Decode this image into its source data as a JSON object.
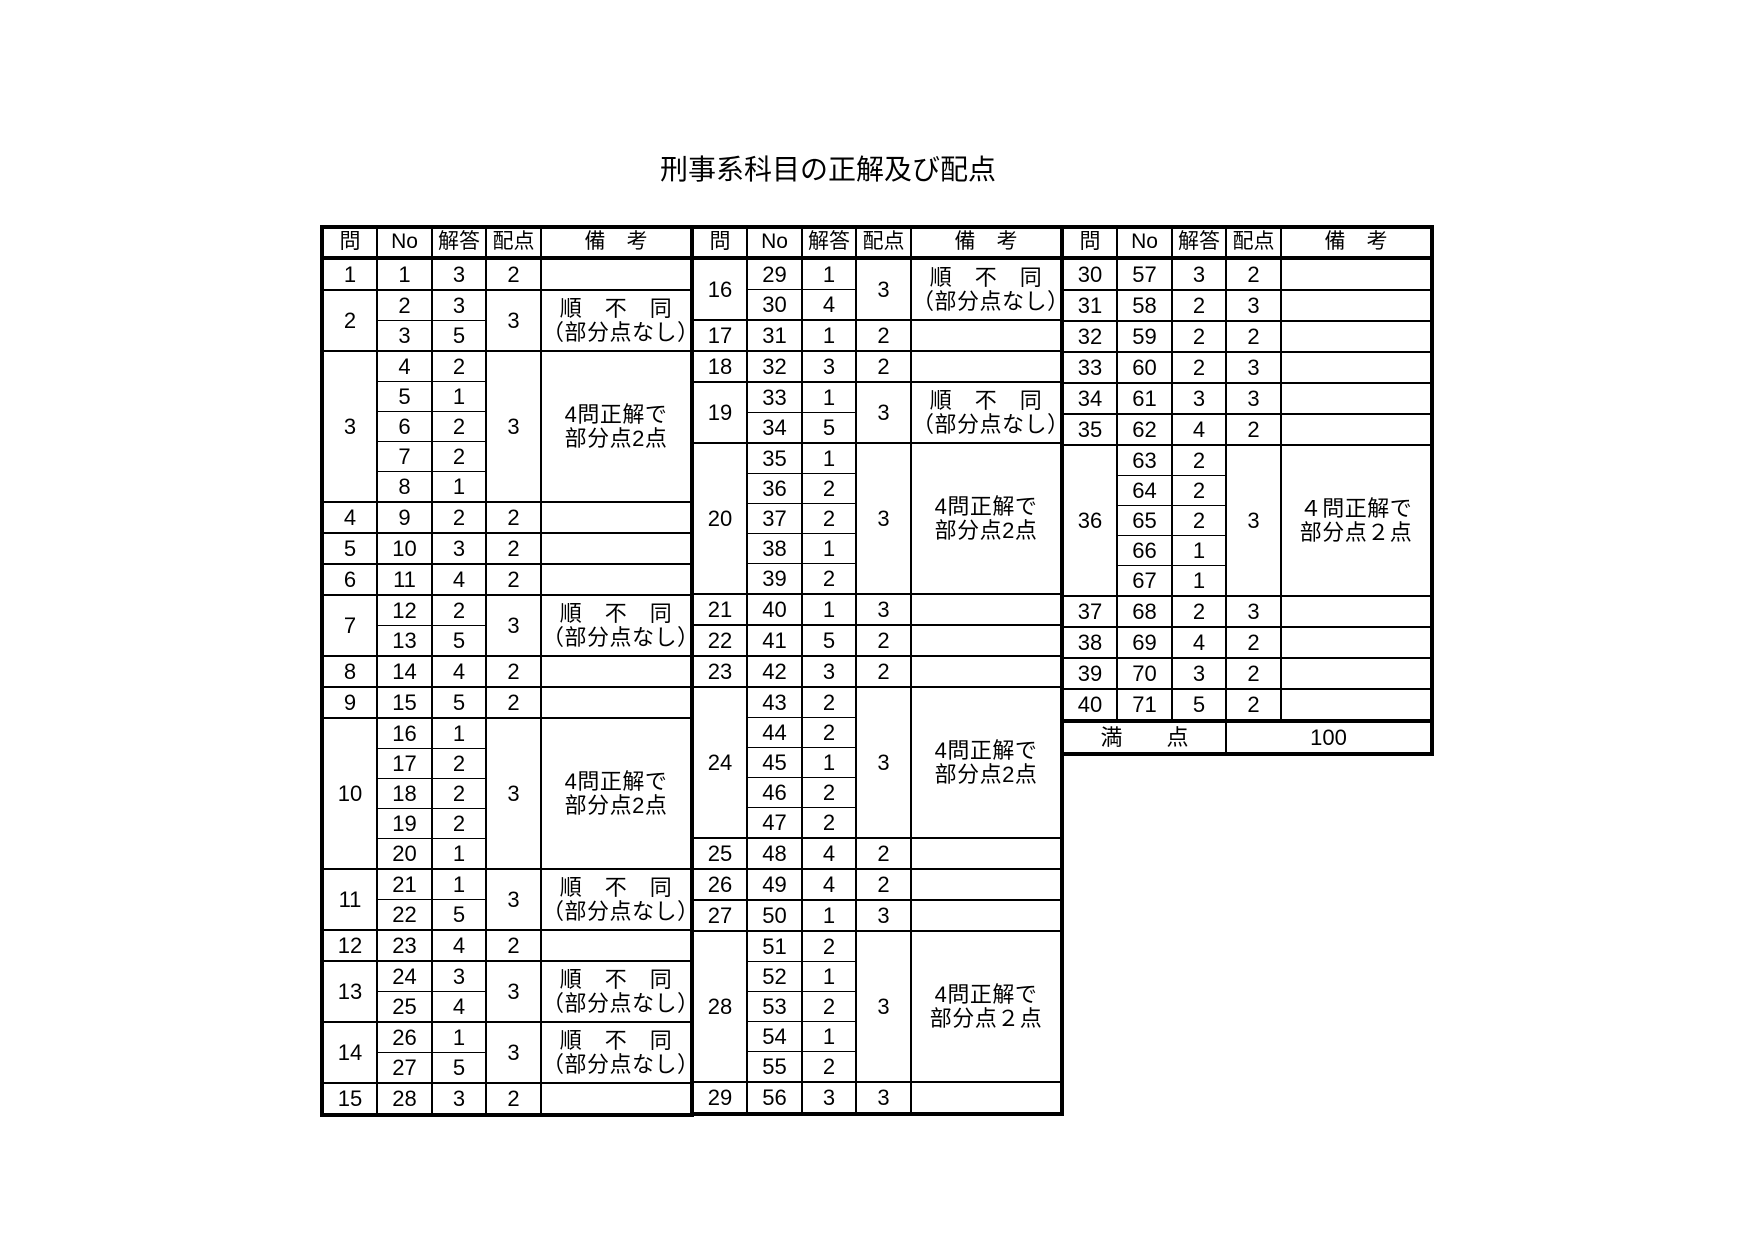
{
  "title": "刑事系科目の正解及び配点",
  "colors": {
    "ink": "#000000",
    "paper": "#ffffff"
  },
  "headers": {
    "q": "問",
    "no": "No",
    "ans": "解答",
    "pts": "配点",
    "note": "備　考"
  },
  "tables": [
    {
      "groups": [
        {
          "q": "1",
          "rows": [
            {
              "no": "1",
              "ans": "3"
            }
          ],
          "pts": "2",
          "note": ""
        },
        {
          "q": "2",
          "rows": [
            {
              "no": "2",
              "ans": "3"
            },
            {
              "no": "3",
              "ans": "5"
            }
          ],
          "pts": "3",
          "note": "順　不　同\n（部分点なし）"
        },
        {
          "q": "3",
          "rows": [
            {
              "no": "4",
              "ans": "2"
            },
            {
              "no": "5",
              "ans": "1"
            },
            {
              "no": "6",
              "ans": "2"
            },
            {
              "no": "7",
              "ans": "2"
            },
            {
              "no": "8",
              "ans": "1"
            }
          ],
          "pts": "3",
          "note": "4問正解で\n部分点2点"
        },
        {
          "q": "4",
          "rows": [
            {
              "no": "9",
              "ans": "2"
            }
          ],
          "pts": "2",
          "note": ""
        },
        {
          "q": "5",
          "rows": [
            {
              "no": "10",
              "ans": "3"
            }
          ],
          "pts": "2",
          "note": ""
        },
        {
          "q": "6",
          "rows": [
            {
              "no": "11",
              "ans": "4"
            }
          ],
          "pts": "2",
          "note": ""
        },
        {
          "q": "7",
          "rows": [
            {
              "no": "12",
              "ans": "2"
            },
            {
              "no": "13",
              "ans": "5"
            }
          ],
          "pts": "3",
          "note": "順　不　同\n（部分点なし）"
        },
        {
          "q": "8",
          "rows": [
            {
              "no": "14",
              "ans": "4"
            }
          ],
          "pts": "2",
          "note": ""
        },
        {
          "q": "9",
          "rows": [
            {
              "no": "15",
              "ans": "5"
            }
          ],
          "pts": "2",
          "note": ""
        },
        {
          "q": "10",
          "rows": [
            {
              "no": "16",
              "ans": "1"
            },
            {
              "no": "17",
              "ans": "2"
            },
            {
              "no": "18",
              "ans": "2"
            },
            {
              "no": "19",
              "ans": "2"
            },
            {
              "no": "20",
              "ans": "1"
            }
          ],
          "pts": "3",
          "note": "4問正解で\n部分点2点"
        },
        {
          "q": "11",
          "rows": [
            {
              "no": "21",
              "ans": "1"
            },
            {
              "no": "22",
              "ans": "5"
            }
          ],
          "pts": "3",
          "note": "順　不　同\n（部分点なし）"
        },
        {
          "q": "12",
          "rows": [
            {
              "no": "23",
              "ans": "4"
            }
          ],
          "pts": "2",
          "note": ""
        },
        {
          "q": "13",
          "rows": [
            {
              "no": "24",
              "ans": "3"
            },
            {
              "no": "25",
              "ans": "4"
            }
          ],
          "pts": "3",
          "note": "順　不　同\n（部分点なし）"
        },
        {
          "q": "14",
          "rows": [
            {
              "no": "26",
              "ans": "1"
            },
            {
              "no": "27",
              "ans": "5"
            }
          ],
          "pts": "3",
          "note": "順　不　同\n（部分点なし）"
        },
        {
          "q": "15",
          "rows": [
            {
              "no": "28",
              "ans": "3"
            }
          ],
          "pts": "2",
          "note": ""
        }
      ]
    },
    {
      "groups": [
        {
          "q": "16",
          "rows": [
            {
              "no": "29",
              "ans": "1"
            },
            {
              "no": "30",
              "ans": "4"
            }
          ],
          "pts": "3",
          "note": "順　不　同\n（部分点なし）"
        },
        {
          "q": "17",
          "rows": [
            {
              "no": "31",
              "ans": "1"
            }
          ],
          "pts": "2",
          "note": ""
        },
        {
          "q": "18",
          "rows": [
            {
              "no": "32",
              "ans": "3"
            }
          ],
          "pts": "2",
          "note": ""
        },
        {
          "q": "19",
          "rows": [
            {
              "no": "33",
              "ans": "1"
            },
            {
              "no": "34",
              "ans": "5"
            }
          ],
          "pts": "3",
          "note": "順　不　同\n（部分点なし）"
        },
        {
          "q": "20",
          "rows": [
            {
              "no": "35",
              "ans": "1"
            },
            {
              "no": "36",
              "ans": "2"
            },
            {
              "no": "37",
              "ans": "2"
            },
            {
              "no": "38",
              "ans": "1"
            },
            {
              "no": "39",
              "ans": "2"
            }
          ],
          "pts": "3",
          "note": "4問正解で\n部分点2点"
        },
        {
          "q": "21",
          "rows": [
            {
              "no": "40",
              "ans": "1"
            }
          ],
          "pts": "3",
          "note": ""
        },
        {
          "q": "22",
          "rows": [
            {
              "no": "41",
              "ans": "5"
            }
          ],
          "pts": "2",
          "note": ""
        },
        {
          "q": "23",
          "rows": [
            {
              "no": "42",
              "ans": "3"
            }
          ],
          "pts": "2",
          "note": ""
        },
        {
          "q": "24",
          "rows": [
            {
              "no": "43",
              "ans": "2"
            },
            {
              "no": "44",
              "ans": "2"
            },
            {
              "no": "45",
              "ans": "1"
            },
            {
              "no": "46",
              "ans": "2"
            },
            {
              "no": "47",
              "ans": "2"
            }
          ],
          "pts": "3",
          "note": "4問正解で\n部分点2点"
        },
        {
          "q": "25",
          "rows": [
            {
              "no": "48",
              "ans": "4"
            }
          ],
          "pts": "2",
          "note": ""
        },
        {
          "q": "26",
          "rows": [
            {
              "no": "49",
              "ans": "4"
            }
          ],
          "pts": "2",
          "note": ""
        },
        {
          "q": "27",
          "rows": [
            {
              "no": "50",
              "ans": "1"
            }
          ],
          "pts": "3",
          "note": ""
        },
        {
          "q": "28",
          "rows": [
            {
              "no": "51",
              "ans": "2"
            },
            {
              "no": "52",
              "ans": "1"
            },
            {
              "no": "53",
              "ans": "2"
            },
            {
              "no": "54",
              "ans": "1"
            },
            {
              "no": "55",
              "ans": "2"
            }
          ],
          "pts": "3",
          "note": "4問正解で\n部分点２点"
        },
        {
          "q": "29",
          "rows": [
            {
              "no": "56",
              "ans": "3"
            }
          ],
          "pts": "3",
          "note": ""
        }
      ]
    },
    {
      "groups": [
        {
          "q": "30",
          "rows": [
            {
              "no": "57",
              "ans": "3"
            }
          ],
          "pts": "2",
          "note": ""
        },
        {
          "q": "31",
          "rows": [
            {
              "no": "58",
              "ans": "2"
            }
          ],
          "pts": "3",
          "note": ""
        },
        {
          "q": "32",
          "rows": [
            {
              "no": "59",
              "ans": "2"
            }
          ],
          "pts": "2",
          "note": ""
        },
        {
          "q": "33",
          "rows": [
            {
              "no": "60",
              "ans": "2"
            }
          ],
          "pts": "3",
          "note": ""
        },
        {
          "q": "34",
          "rows": [
            {
              "no": "61",
              "ans": "3"
            }
          ],
          "pts": "3",
          "note": ""
        },
        {
          "q": "35",
          "rows": [
            {
              "no": "62",
              "ans": "4"
            }
          ],
          "pts": "2",
          "note": ""
        },
        {
          "q": "36",
          "rows": [
            {
              "no": "63",
              "ans": "2"
            },
            {
              "no": "64",
              "ans": "2"
            },
            {
              "no": "65",
              "ans": "2"
            },
            {
              "no": "66",
              "ans": "1"
            },
            {
              "no": "67",
              "ans": "1"
            }
          ],
          "pts": "3",
          "note": "４問正解で\n部分点２点"
        },
        {
          "q": "37",
          "rows": [
            {
              "no": "68",
              "ans": "2"
            }
          ],
          "pts": "3",
          "note": ""
        },
        {
          "q": "38",
          "rows": [
            {
              "no": "69",
              "ans": "4"
            }
          ],
          "pts": "2",
          "note": ""
        },
        {
          "q": "39",
          "rows": [
            {
              "no": "70",
              "ans": "3"
            }
          ],
          "pts": "2",
          "note": ""
        },
        {
          "q": "40",
          "rows": [
            {
              "no": "71",
              "ans": "5"
            }
          ],
          "pts": "2",
          "note": ""
        }
      ],
      "footer": {
        "label": "満　　点",
        "value": "100"
      }
    }
  ]
}
